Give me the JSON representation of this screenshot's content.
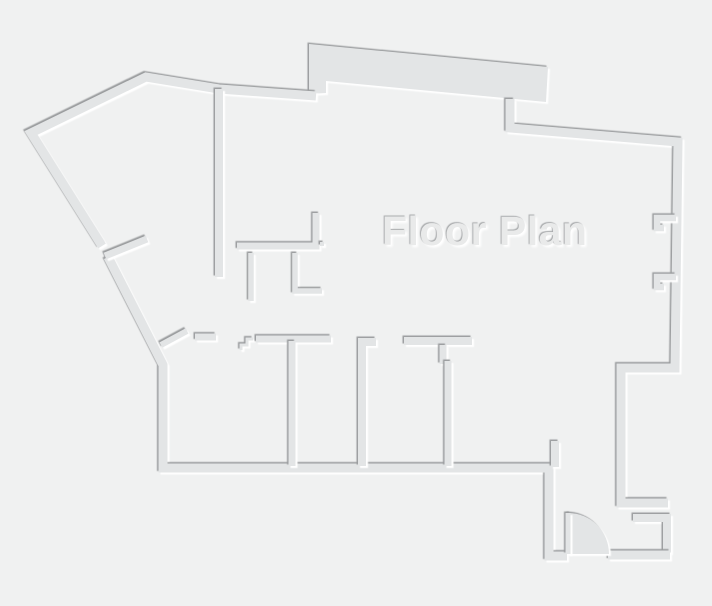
{
  "canvas": {
    "width": 712,
    "height": 606,
    "background": "#f0f1f1"
  },
  "title": {
    "label": "Floor Plan"
  },
  "palette": {
    "wall_fill": "#e3e5e6",
    "edge_shadow_dark": "#9a9c9e",
    "edge_highlight_light": "#ffffff",
    "title_fill": "#e9eaea",
    "title_shadow_dark": "#a8aaac",
    "title_highlight": "#ffffff"
  },
  "floor_plan": {
    "shapes": [
      {
        "name": "north-annex-band",
        "kind": "polygon",
        "points": [
          [
            309,
            94
          ],
          [
            309,
            44
          ],
          [
            548,
            67
          ],
          [
            546,
            102
          ],
          [
            326,
            81
          ],
          [
            326,
            93
          ]
        ]
      },
      {
        "name": "northwest-perimeter-wall",
        "kind": "polyline",
        "width": 9,
        "points": [
          [
            102,
            246
          ],
          [
            31,
            133
          ],
          [
            146,
            77
          ],
          [
            219,
            89
          ],
          [
            316,
            96
          ]
        ]
      },
      {
        "name": "southwest-perimeter-wall",
        "kind": "polyline",
        "width": 9,
        "points": [
          [
            108,
            257
          ],
          [
            163,
            365
          ],
          [
            163,
            468
          ],
          [
            549,
            468
          ],
          [
            549,
            556
          ],
          [
            567,
            556
          ]
        ]
      },
      {
        "name": "south-wall-stub",
        "kind": "polyline",
        "width": 8,
        "points": [
          [
            555,
            441
          ],
          [
            555,
            467
          ]
        ]
      },
      {
        "name": "northeast-perimeter-wall",
        "kind": "polyline",
        "width": 9,
        "points": [
          [
            510,
            99
          ],
          [
            510,
            128
          ],
          [
            678,
            142
          ],
          [
            675,
            368
          ],
          [
            621,
            368
          ],
          [
            621,
            503
          ],
          [
            668,
            503
          ]
        ]
      },
      {
        "name": "southeast-alcove-wall",
        "kind": "polyline",
        "width": 8,
        "points": [
          [
            633,
            518
          ],
          [
            667,
            518
          ],
          [
            667,
            553
          ]
        ]
      },
      {
        "name": "southeast-bottom-wall",
        "kind": "polyline",
        "width": 9,
        "points": [
          [
            608,
            555
          ],
          [
            670,
            555
          ]
        ]
      },
      {
        "name": "east-window-jamb-upper",
        "kind": "polyline",
        "width": 6.5,
        "points": [
          [
            676,
            218
          ],
          [
            657,
            218
          ],
          [
            657,
            228
          ],
          [
            664,
            228
          ]
        ]
      },
      {
        "name": "east-window-jamb-lower",
        "kind": "polyline",
        "width": 6.5,
        "points": [
          [
            676,
            277
          ],
          [
            657,
            277
          ],
          [
            657,
            287
          ],
          [
            664,
            287
          ]
        ]
      },
      {
        "name": "hall-partition-wall",
        "kind": "polyline",
        "width": 8,
        "points": [
          [
            219,
            89
          ],
          [
            219,
            277
          ]
        ]
      },
      {
        "name": "closet-partition-wall",
        "kind": "polyline",
        "width": 7,
        "points": [
          [
            316,
            213
          ],
          [
            316,
            246
          ],
          [
            237,
            246
          ]
        ]
      },
      {
        "name": "closet-divider-left",
        "kind": "polyline",
        "width": 5.5,
        "points": [
          [
            251,
            253
          ],
          [
            251,
            301
          ]
        ]
      },
      {
        "name": "closet-divider-right",
        "kind": "polyline",
        "width": 5.5,
        "points": [
          [
            295,
            253
          ],
          [
            295,
            291
          ],
          [
            322,
            291
          ]
        ]
      },
      {
        "name": "jamb-dot",
        "kind": "polygon",
        "points": [
          [
            320,
            242
          ],
          [
            324,
            242
          ],
          [
            324,
            246
          ],
          [
            320,
            246
          ]
        ]
      },
      {
        "name": "entry-wall-segment",
        "kind": "polyline",
        "width": 7,
        "points": [
          [
            195,
            337
          ],
          [
            216,
            337
          ]
        ]
      },
      {
        "name": "interior-door-leaf",
        "kind": "polyline",
        "width": 6,
        "points": [
          [
            161,
            345
          ],
          [
            187,
            331
          ]
        ]
      },
      {
        "name": "threshold-step",
        "kind": "polyline",
        "width": 3,
        "points": [
          [
            241,
            350
          ],
          [
            241,
            345
          ],
          [
            247,
            345
          ],
          [
            247,
            339
          ],
          [
            253,
            339
          ]
        ]
      },
      {
        "name": "rooms-top-wall-left",
        "kind": "polyline",
        "width": 7,
        "points": [
          [
            256,
            339
          ],
          [
            331,
            339
          ]
        ]
      },
      {
        "name": "room-divider-1",
        "kind": "polyline",
        "width": 7,
        "points": [
          [
            292,
            341
          ],
          [
            292,
            466
          ]
        ]
      },
      {
        "name": "room-divider-2",
        "kind": "polyline",
        "width": 8,
        "points": [
          [
            376,
            342
          ],
          [
            362,
            342
          ],
          [
            362,
            466
          ]
        ]
      },
      {
        "name": "rooms-top-wall-right",
        "kind": "polyline",
        "width": 8,
        "points": [
          [
            404,
            341
          ],
          [
            472,
            341
          ]
        ]
      },
      {
        "name": "room-divider-3-jamb",
        "kind": "polyline",
        "width": 7,
        "points": [
          [
            443,
            345
          ],
          [
            443,
            364
          ]
        ]
      },
      {
        "name": "room-divider-3",
        "kind": "polyline",
        "width": 7,
        "points": [
          [
            448,
            361
          ],
          [
            448,
            466
          ]
        ]
      },
      {
        "name": "west-door-leaf",
        "kind": "polyline",
        "width": 7,
        "points": [
          [
            105,
            256
          ],
          [
            147,
            239
          ]
        ]
      },
      {
        "name": "south-door-swing",
        "kind": "path",
        "d": "M 568 554 L 568 513 A 41 41 0 0 1 609 554 Z"
      },
      {
        "name": "south-door-leaf",
        "kind": "polyline",
        "width": 5,
        "points": [
          [
            568,
            513
          ],
          [
            568,
            554
          ]
        ]
      }
    ]
  }
}
